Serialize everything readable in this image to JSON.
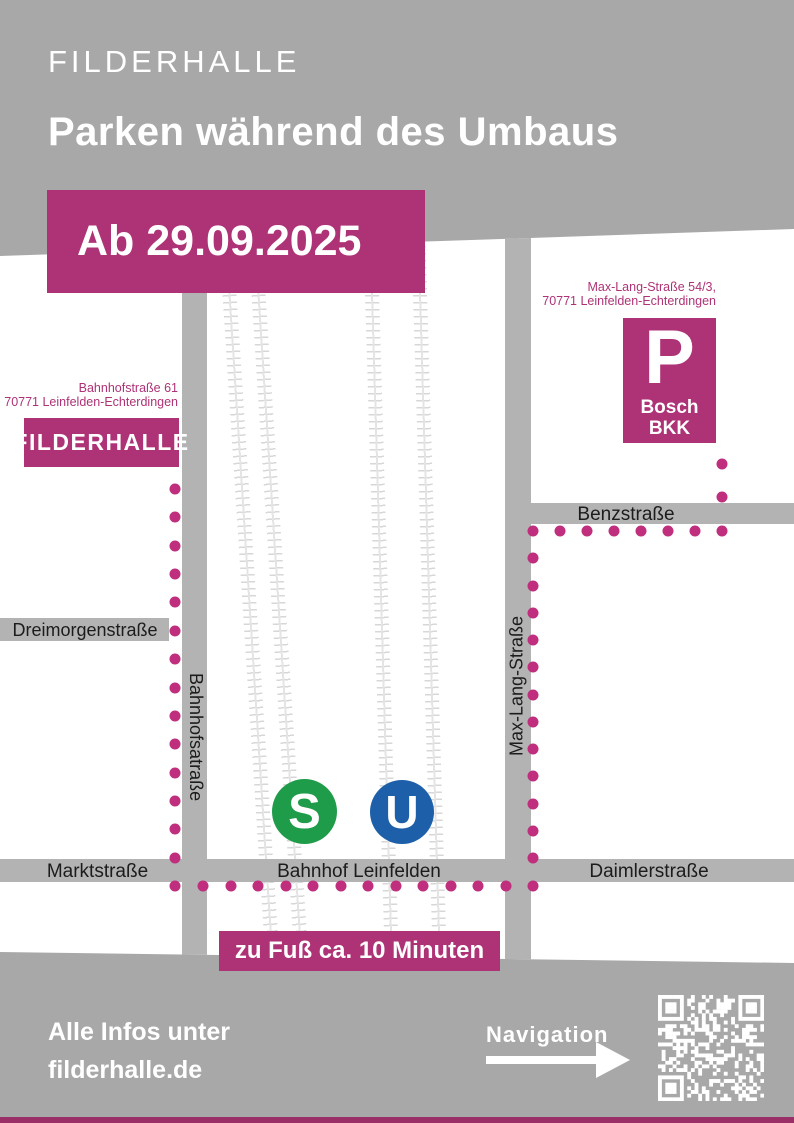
{
  "colors": {
    "background": "#a8a8a8",
    "street": "#b3b3b3",
    "street_text": "#1c1c1c",
    "accent": "#ae3276",
    "dot": "#bf2f7d",
    "sbahn_green": "#1f9c49",
    "ubahn_blue": "#1d60a9",
    "track_rail": "#e4e4e4",
    "track_tie": "#d7d7d7",
    "footer_bar": "#9a2e67"
  },
  "header": {
    "brand": "FILDERHALLE",
    "title": "Parken während des Umbaus",
    "date_badge": "Ab 29.09.2025"
  },
  "map": {
    "filderhalle": {
      "label": "FILDERHALLE",
      "address_line1": "Bahnhofstraße 61",
      "address_line2": "70771 Leinfelden-Echterdingen"
    },
    "parking": {
      "symbol": "P",
      "name_line1": "Bosch",
      "name_line2": "BKK",
      "address_line1": "Max-Lang-Straße 54/3,",
      "address_line2": "70771 Leinfelden-Echterdingen"
    },
    "streets": {
      "dreimorgenstrasse": "Dreimorgenstraße",
      "bahnhofsatrasse": "Bahnhofsatraße",
      "marktstrasse": "Marktstraße",
      "bahnhof_leinfelden": "Bahnhof Leinfelden",
      "daimlerstrasse": "Daimlerstraße",
      "benzstrasse": "Benzstraße",
      "max_lang_strasse": "Max-Lang-Straße"
    },
    "transit": {
      "sbahn": "S",
      "ubahn": "U"
    },
    "walk_badge": "zu Fuß ca. 10 Minuten",
    "route_dot_spacing": 27.5,
    "routes": [
      {
        "x1": 175,
        "y1": 489,
        "x2": 175,
        "y2": 886
      },
      {
        "x1": 203,
        "y1": 886,
        "x2": 533,
        "y2": 886
      },
      {
        "x1": 533,
        "y1": 531,
        "x2": 533,
        "y2": 858
      },
      {
        "x1": 560,
        "y1": 531,
        "x2": 722,
        "y2": 531
      },
      {
        "x1": 722,
        "y1": 464,
        "x2": 722,
        "y2": 497
      }
    ]
  },
  "footer": {
    "info_line1": "Alle Infos unter",
    "info_line2": "filderhalle.de",
    "navigation_label": "Navigation"
  }
}
